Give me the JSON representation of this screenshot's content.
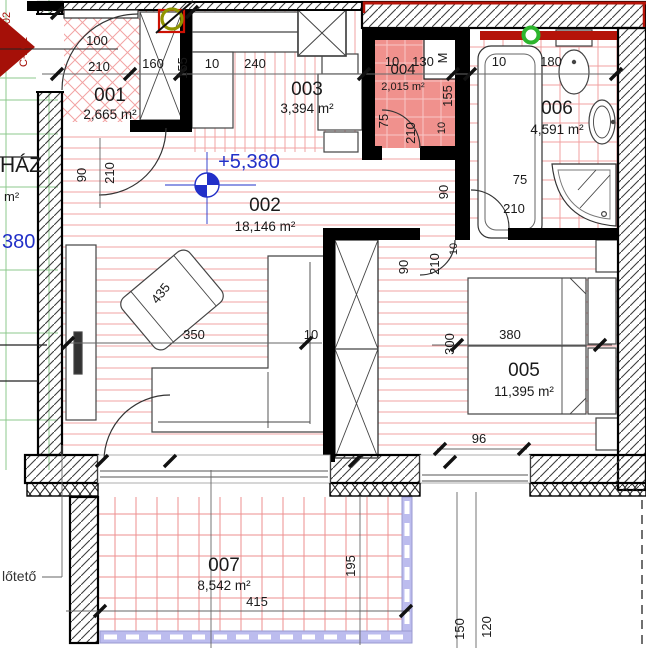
{
  "rooms": [
    {
      "num": "001",
      "area": "2,665 m²"
    },
    {
      "num": "002",
      "area": "18,146 m²"
    },
    {
      "num": "003",
      "area": "3,394 m²"
    },
    {
      "num": "004",
      "area": "2,015 m²"
    },
    {
      "num": "005",
      "area": "11,395 m²"
    },
    {
      "num": "006",
      "area": "4,591 m²"
    },
    {
      "num": "007",
      "area": "8,542 m²"
    }
  ],
  "levels": {
    "main": "+5,380",
    "left_partial": "380"
  },
  "annotations": {
    "staircase_partial": "HÁZ",
    "staircase_area_partial": "m²",
    "canopy_partial": "lőtető",
    "section_marker": "C-201",
    "section_marker_partial": "02"
  },
  "dims": [
    "100",
    "210",
    "160",
    "155",
    "10",
    "240",
    "10",
    "130",
    "155",
    "75",
    "210",
    "10",
    "10",
    "180",
    "M",
    "90",
    "210",
    "75",
    "210",
    "90",
    "90",
    "210",
    "10",
    "350",
    "10",
    "435",
    "380",
    "300",
    "96",
    "415",
    "195",
    "150",
    "120"
  ],
  "colors": {
    "level_blue": "#2230c8",
    "accent_red": "#b51409",
    "section_red": "#a51008",
    "wall_pink": "#f0918d",
    "floor_hatch_red": "#f2a3a3",
    "grid_green": "#8cc88c",
    "railing_lavender": "#bcbcee",
    "marker_green": "#2db52d",
    "marker_olive": "#8f9400"
  }
}
